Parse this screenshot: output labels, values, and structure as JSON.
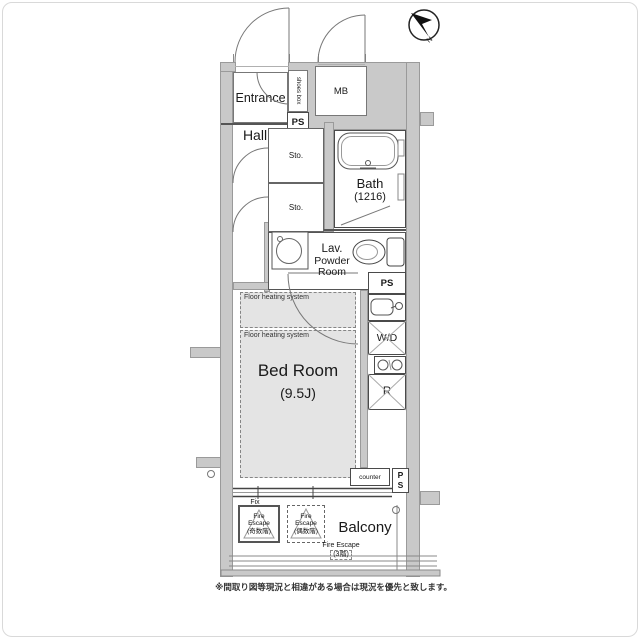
{
  "compass": {
    "label": "N"
  },
  "labels": {
    "entrance": "Entrance",
    "shoes_box": "shoes box",
    "ps_top": "PS",
    "mb": "MB",
    "hall": "Hall",
    "sto1": "Sto.",
    "sto2": "Sto.",
    "bath": "Bath",
    "bath_size": "(1216)",
    "lav1": "Lav.",
    "lav2": "Powder",
    "lav3": "Room",
    "ps_mid": "PS",
    "wd": "W/D",
    "r": "R",
    "fh1": "Floor heating system",
    "fh2": "Floor heating system",
    "bedroom": "Bed Room",
    "bedroom_size": "(9.5J)",
    "counter": "counter",
    "ps_p": "P",
    "ps_s": "S",
    "fix": "Fix",
    "fe_odd1": "Fire",
    "fe_odd2": "Escape",
    "fe_odd3": "(奇数階)",
    "fe_even1": "Fire",
    "fe_even2": "Escape",
    "fe_even3": "(偶数階)",
    "fe3_1": "Fire Escape",
    "fe3_2": "(3階)",
    "balcony": "Balcony"
  },
  "footer": {
    "note": "※間取り図等現況と相違がある場合は現況を優先と致します。"
  }
}
